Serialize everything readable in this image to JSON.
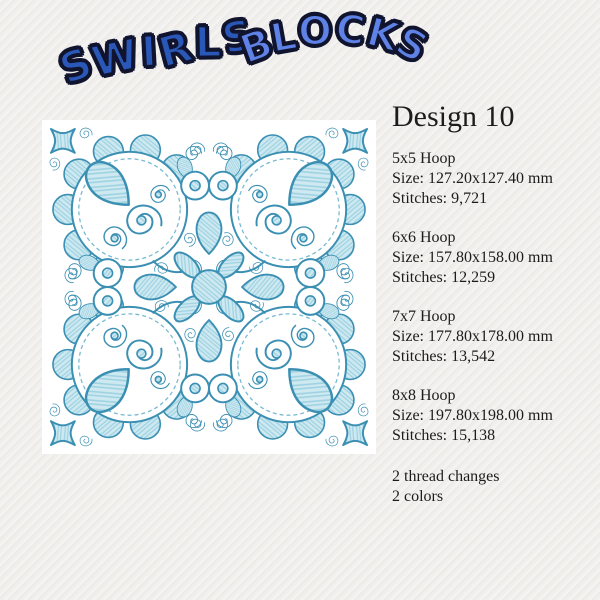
{
  "logo": {
    "word1": "SWIRLS",
    "word2": "BLOCKS",
    "word1_fill": "#2a58b8",
    "word2_fill": "#5e82e6",
    "outline_color": "#10142e"
  },
  "panel": {
    "title": "Design 10",
    "specs": [
      {
        "hoop": "5x5 Hoop",
        "size": "Size: 127.20x127.40 mm",
        "stitches": "Stitches: 9,721"
      },
      {
        "hoop": "6x6 Hoop",
        "size": "Size: 157.80x158.00 mm",
        "stitches": "Stitches: 12,259"
      },
      {
        "hoop": "7x7 Hoop",
        "size": "Size: 177.80x178.00 mm",
        "stitches": "Stitches: 13,542"
      },
      {
        "hoop": "8x8 Hoop",
        "size": "Size: 197.80x198.00 mm",
        "stitches": "Stitches: 15,138"
      }
    ],
    "notes": [
      "2 thread changes",
      "2 colors"
    ]
  },
  "artwork": {
    "thread_light_color": "#7cc0d4",
    "thread_dark_color": "#3b8fb2"
  }
}
